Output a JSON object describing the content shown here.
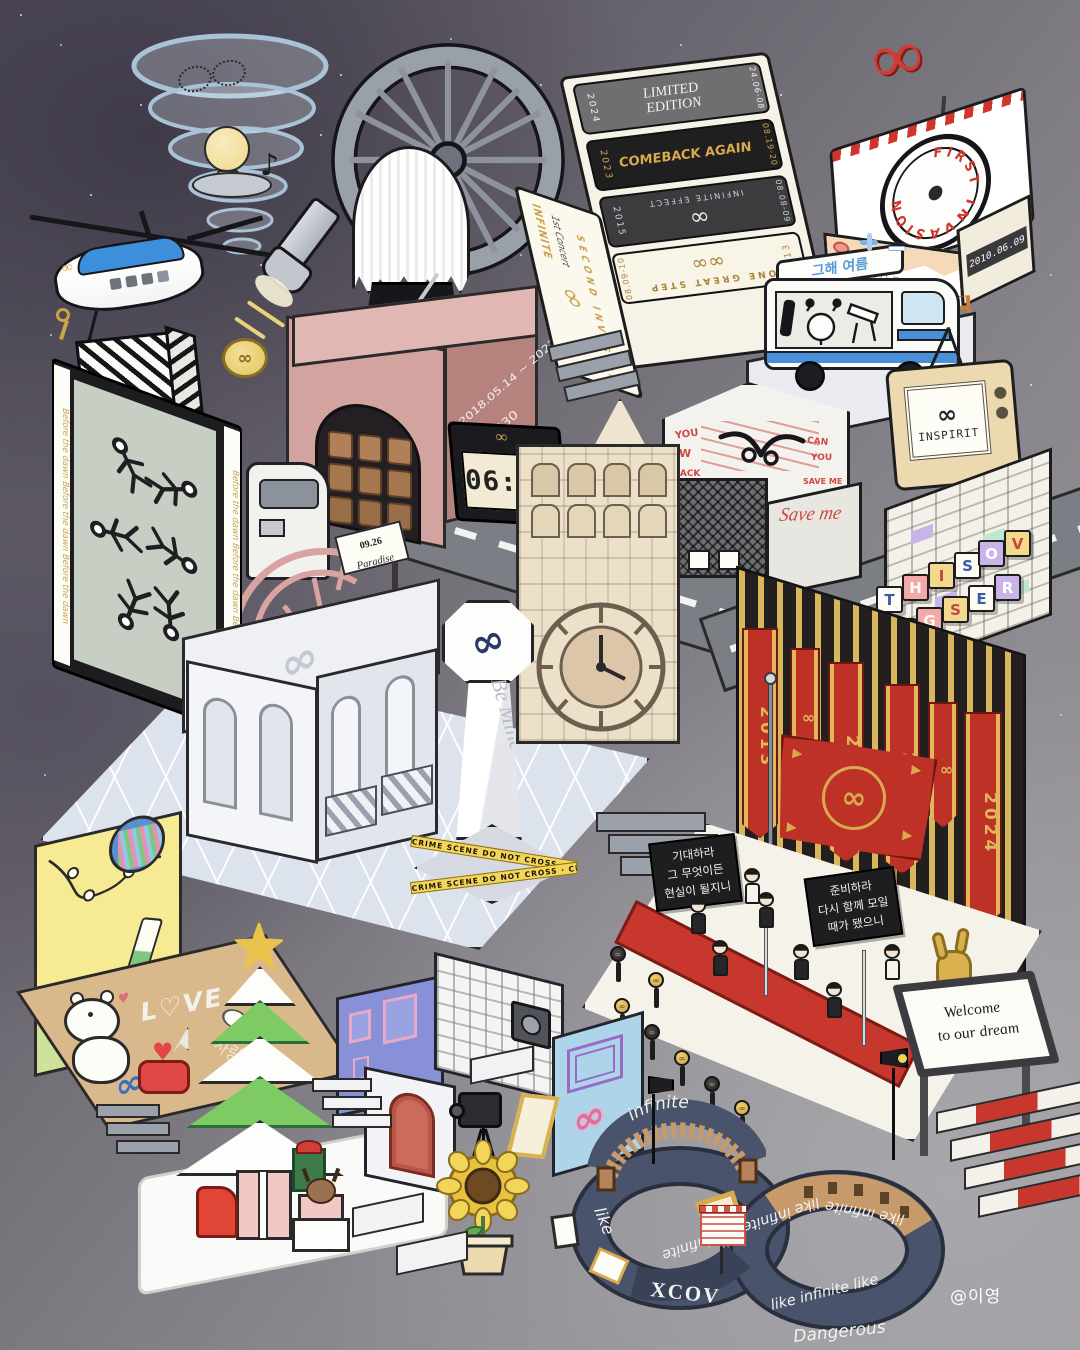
{
  "artwork": {
    "signature": "@이영"
  },
  "symbols": {
    "infinity": "∞",
    "music_note": "♪",
    "heart": "♥"
  },
  "tickets": {
    "side": {
      "brand": "INFINITE",
      "title": "1st Concert",
      "logo": "∞",
      "name": "SECOND INVASION"
    },
    "items": [
      {
        "year": "2024",
        "title_line1": "LIMITED",
        "title_line2": "EDITION",
        "date": "24.06-08"
      },
      {
        "year": "2023",
        "title_line1": "COMEBACK AGAIN",
        "title_line2": "",
        "date": "08.19-20"
      },
      {
        "year": "2015",
        "title_line1": "INFINITE EFFECT",
        "title_line2": "∞",
        "date": "08.08-09"
      },
      {
        "year": "2013",
        "title_line1": "ONE GREAT STEP",
        "title_line2": "∞∞",
        "date": "08.09-10"
      }
    ]
  },
  "pizza": {
    "circle_text": "FIRST INVASION",
    "date": "2010.06.09",
    "side_text": "다시 나 돌아갈래",
    "balloon": "∞"
  },
  "van": {
    "roof_text": "그해 여름"
  },
  "tv": {
    "logo": "∞",
    "label": "INSPIRIT"
  },
  "arch_building": {
    "date_range": "2018.05.14 ~ 2022.08.21",
    "d_day": "D-2030"
  },
  "clock": {
    "time": "06:03",
    "logo": "∞"
  },
  "graffiti": {
    "roof_text": "Save me",
    "w1": "YOU",
    "w2": "AW",
    "w3": "CAN",
    "w4": "YOU",
    "w5": "BACK",
    "w6": "SAVE ME"
  },
  "billboard": {
    "border_text": "Before the dawn Before the dawn Before the dawn",
    "logo": "∕∕∕"
  },
  "road_sign": {
    "date": "09.26",
    "name": "Paradise"
  },
  "pavilion": {
    "emblem": "∞"
  },
  "obelisk": {
    "logo": "∞",
    "text": "Be Mine",
    "tape": "CRIME SCENE DO NOT CROSS · CRIME SCENE DO NOT CROSS"
  },
  "blocks": {
    "letters": [
      "T",
      "H",
      "I",
      "S",
      "O",
      "V",
      "N",
      "G",
      "S",
      "E",
      "R",
      "N",
      "O"
    ]
  },
  "banners": {
    "years": [
      "2013",
      "∞",
      "2015",
      "2017",
      "∞",
      "2024"
    ]
  },
  "flag": {
    "crest": "∞"
  },
  "stage": {
    "sign_left": [
      "기대하라",
      "그 무엇이든",
      "현실이 될지니"
    ],
    "sign_right": [
      "준비하라",
      "다시 함께 모일",
      "때가 됐으니"
    ]
  },
  "welcome": {
    "lines": [
      "Welcome",
      "to our dream"
    ]
  },
  "love_room": {
    "love": "L♡VE",
    "korean": "사랑해",
    "infinity": "∞"
  },
  "mv_set": {
    "neon": "∞"
  },
  "ribbon": {
    "arch": "infinite",
    "left": "like",
    "middle": "like infinite like infinite",
    "right_top": "like infinite",
    "right_bottom": "like infinite like",
    "bottom": "Dangerous",
    "logo": "XCOV"
  },
  "heli": {
    "logo": "∞"
  },
  "coin": {
    "logo": "∞"
  }
}
